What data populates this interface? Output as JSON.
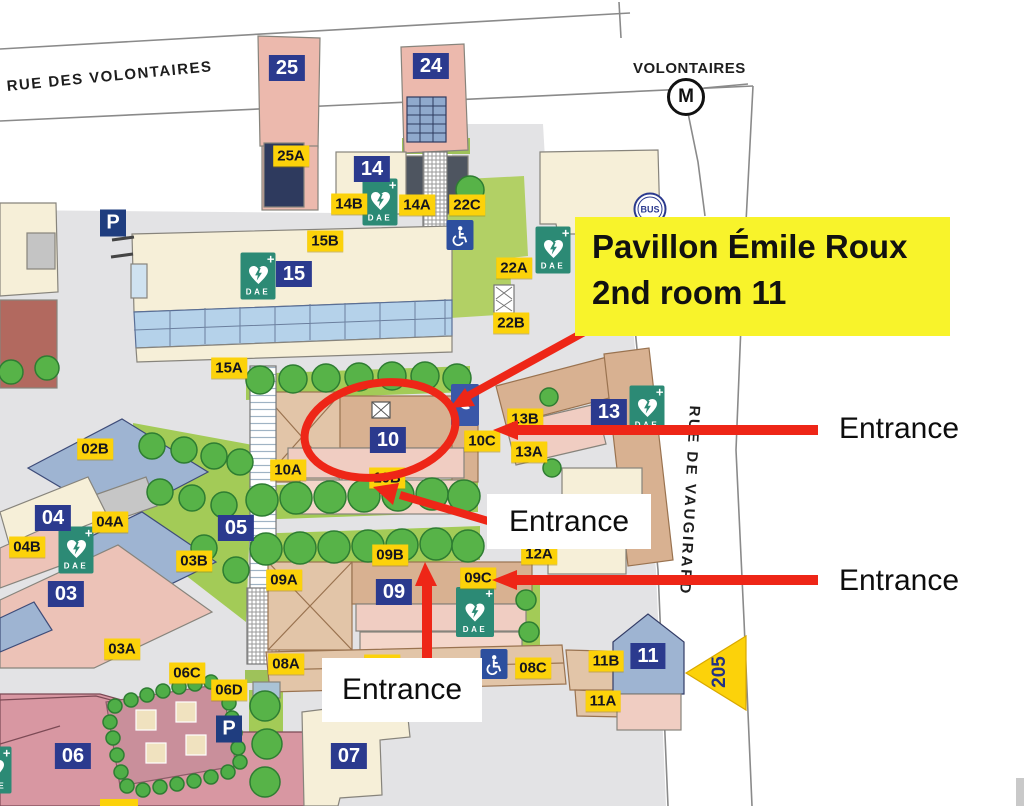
{
  "streets": {
    "rue_des_volontaires": "RUE DES VOLONTAIRES",
    "volontaires_station": "VOLONTAIRES",
    "metro_m": "M",
    "bus": "BUS",
    "rue_de_vaugirard": "RUE DE VAUGIRARD",
    "route_205": "205"
  },
  "signs": {
    "parking": "P",
    "dae": "DAE"
  },
  "labels": {
    "blue": [
      "25",
      "24",
      "14",
      "15",
      "10",
      "13",
      "04",
      "05",
      "03",
      "09",
      "06",
      "11",
      "07"
    ],
    "yellow": [
      "25A",
      "14B",
      "14A",
      "22C",
      "15B",
      "15A",
      "22A",
      "22B",
      "02B",
      "10A",
      "10B",
      "10C",
      "13B",
      "13A",
      "04A",
      "04B",
      "03B",
      "03A",
      "09A",
      "09B",
      "09C",
      "12A",
      "06C",
      "06D",
      "08A",
      "08B",
      "08C",
      "11B",
      "11A"
    ]
  },
  "annotation": {
    "highlight_line1": "Pavillon Émile Roux",
    "highlight_line2": "2nd room 11",
    "highlight_bg": "#f8f32b",
    "arrow_color": "#ee2617",
    "entrances": [
      "Entrance",
      "Entrance",
      "Entrance",
      "Entrance"
    ]
  },
  "colors": {
    "label_yellow": "#fcd20a",
    "label_blue": "#2b3a8e",
    "dae_teal": "#2c8a75",
    "annotation_red": "#ee2617",
    "ground_grey": "#e3e3e5",
    "lawn_green": "#a3cb57"
  }
}
